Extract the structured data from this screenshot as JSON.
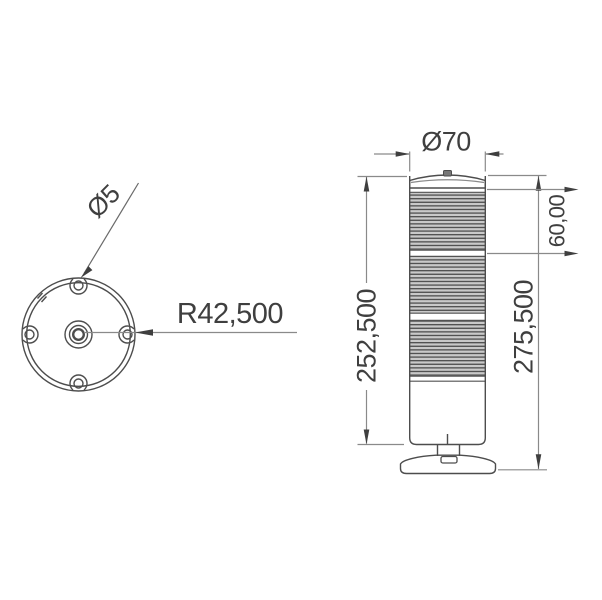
{
  "top_view": {
    "labels": {
      "hole_diameter": "Ø5",
      "mount_radius": "R42,500"
    }
  },
  "front_view": {
    "labels": {
      "diameter": "Ø70",
      "module_height": "60,00",
      "body_height": "252,500",
      "total_height": "275,500"
    }
  },
  "colors": {
    "outline": "#4d4d4d",
    "dimension_line": "#8a8a8a",
    "arrow_and_text": "#3f3f3f",
    "rib_gap": "#c9c9c9",
    "rib_line": "#525252",
    "cap_fill": "#f2f2f2",
    "background": "#ffffff"
  }
}
